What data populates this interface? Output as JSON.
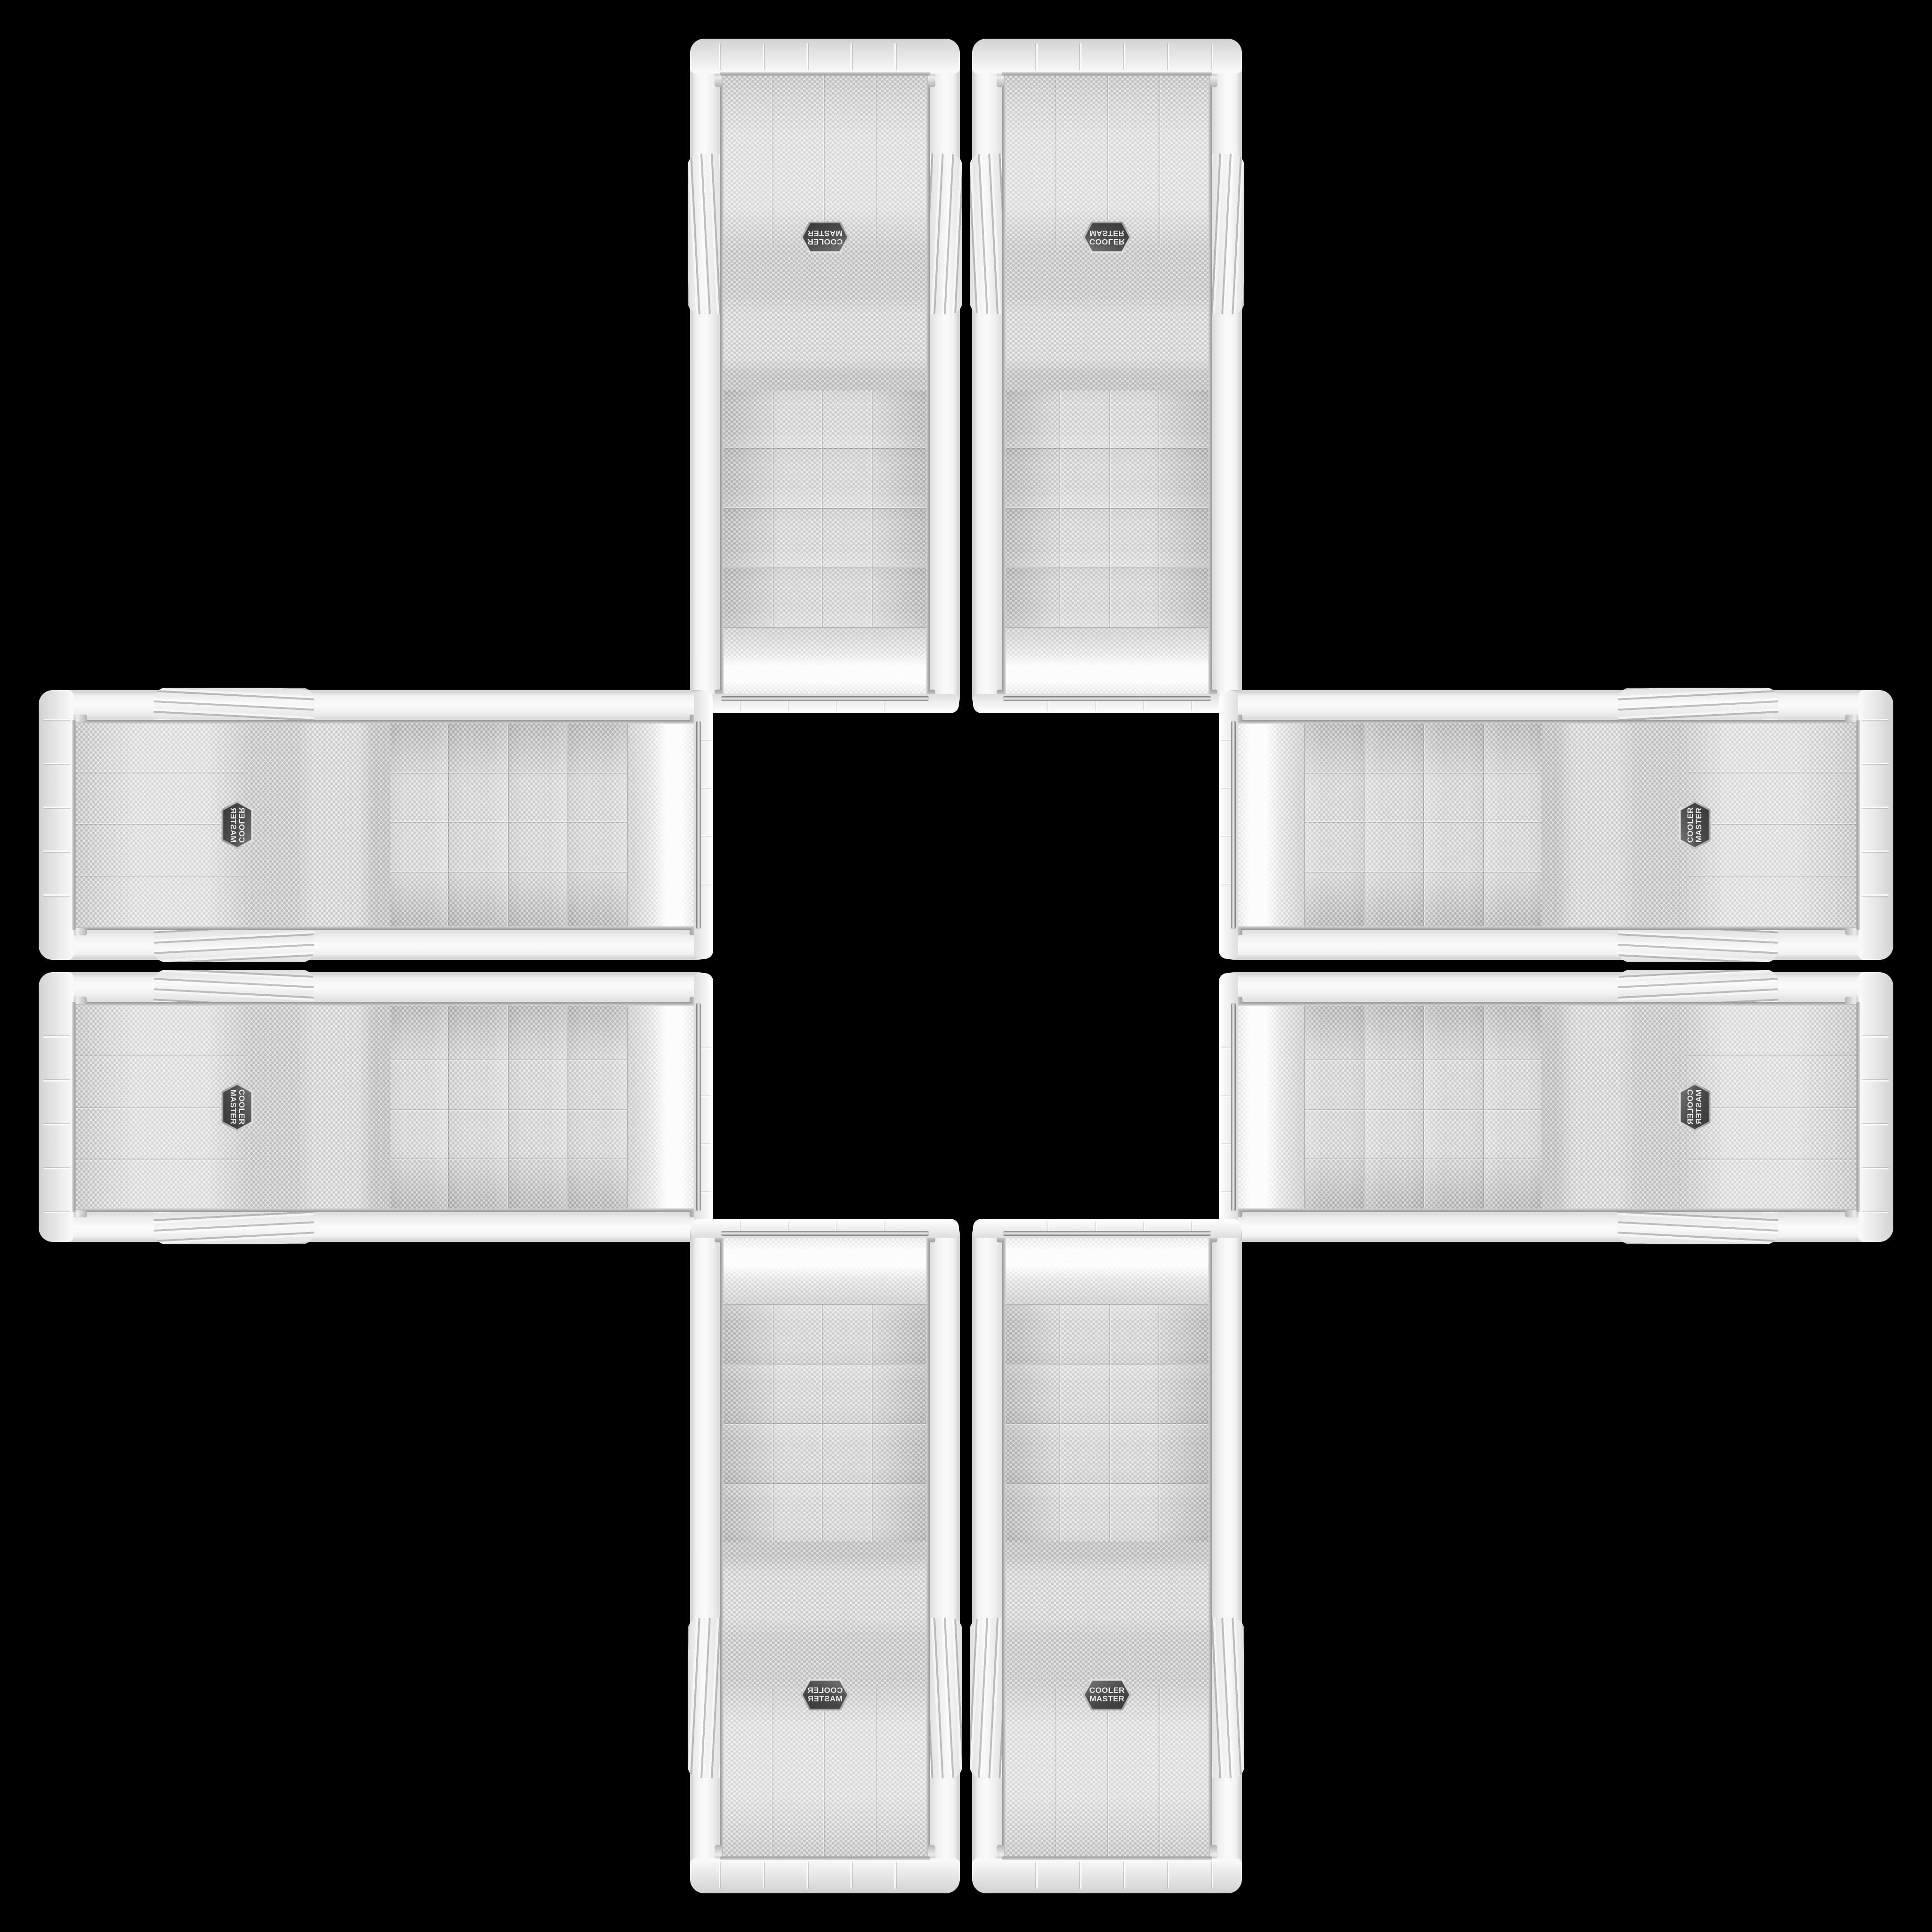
{
  "scene": {
    "type": "product-photo-collage",
    "background_color": "#000000",
    "description": "Eight identical white Cooler Master mid-tower PC case front panels arranged edge-to-edge in a cross (plus-sign) kaleidoscope pattern around an empty black center; each arm holds two mirrored panels, side arms rotated 90 degrees",
    "case_count": 8
  },
  "brand": {
    "name": "Cooler Master",
    "badge_line1": "COOLER",
    "badge_line2": "MASTER"
  },
  "panel": {
    "sections": {
      "top_bezel": "white cap with chrome trim strip",
      "top_mesh": "curved fine perforated grille with specular highlight",
      "drive_bay_count": 4,
      "drive_bays": "four perforated 5.25-inch bay covers separated by seams",
      "fan_mesh": "large perforated grille with centered hexagonal logo badge",
      "side_rails": "glossy white rails with ribbed grip zone near logo height",
      "bottom_bezel": "white segmented cap with chrome trim strip"
    },
    "colors": {
      "shell_white": "#f2f2f2",
      "shell_shadow": "#c9c9c9",
      "mesh_base": "#ececec",
      "mesh_dot": "#c5c5c5",
      "bay_mesh_base": "#e4e4e4",
      "bay_mesh_dot": "#b9b9b9",
      "top_mesh_base": "#f4f4f4",
      "top_mesh_dot": "#d8d8d8",
      "chrome_trim": "#8e8e8e",
      "badge_face": "#4d4d4d",
      "badge_bevel": "#d2d2d2",
      "badge_text": "#ebebeb"
    }
  },
  "cases": [
    {
      "id": "top-left",
      "arm": "top",
      "orientation": "rotated 180 degrees"
    },
    {
      "id": "top-right",
      "arm": "top",
      "orientation": "flipped vertically"
    },
    {
      "id": "left-top",
      "arm": "left",
      "orientation": "rotated 90 CW and flipped"
    },
    {
      "id": "left-bottom",
      "arm": "left",
      "orientation": "rotated 90 CW"
    },
    {
      "id": "right-top",
      "arm": "right",
      "orientation": "rotated 90 CCW"
    },
    {
      "id": "right-bottom",
      "arm": "right",
      "orientation": "rotated 90 CCW and flipped"
    },
    {
      "id": "bottom-left",
      "arm": "bottom",
      "orientation": "mirrored horizontally"
    },
    {
      "id": "bottom-right",
      "arm": "bottom",
      "orientation": "upright"
    }
  ]
}
